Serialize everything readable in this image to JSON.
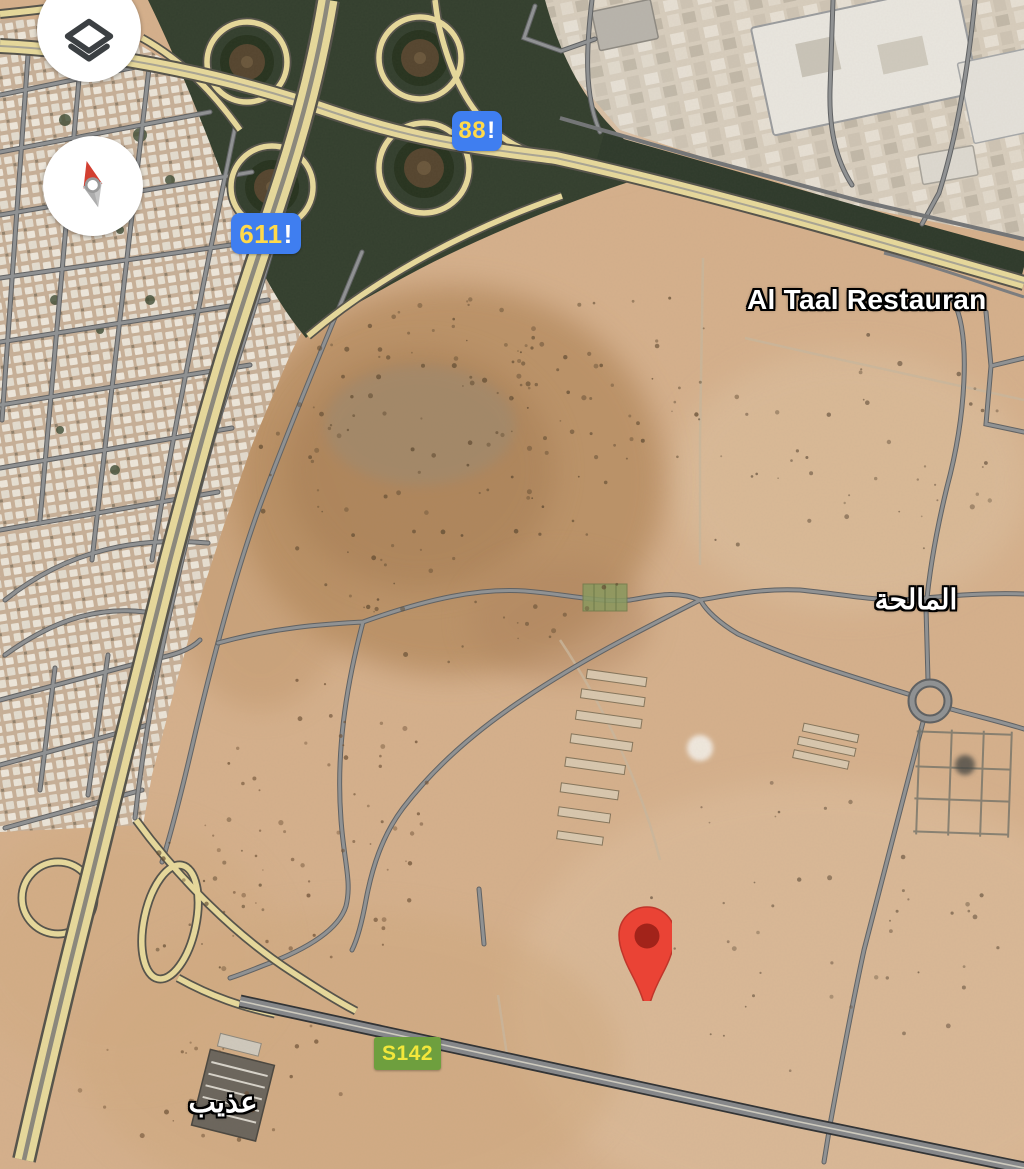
{
  "map": {
    "controls": {
      "layers_icon": "stacked-layers-diamond",
      "compass_icon": "compass-needle-north"
    },
    "route_badges": [
      {
        "id": "route-88",
        "number": "88",
        "suffix": "!",
        "bg_color": "#3F7EF0",
        "text_color": "#FFD94A"
      },
      {
        "id": "route-611",
        "number": "611",
        "suffix": "!",
        "bg_color": "#3F7EF0",
        "text_color": "#FFD94A"
      },
      {
        "id": "route-s142",
        "number": "S142",
        "suffix": "",
        "bg_color": "#6E9F3E",
        "text_color": "#F2E73B"
      }
    ],
    "place_labels": [
      {
        "id": "al-taal",
        "text": "Al Taal Restauran"
      },
      {
        "id": "al-malha",
        "text": "المالحة"
      },
      {
        "id": "adheeb",
        "text": "عذيب"
      }
    ],
    "marker": {
      "color": "#EA4335",
      "inner_color": "#A2231A"
    }
  }
}
